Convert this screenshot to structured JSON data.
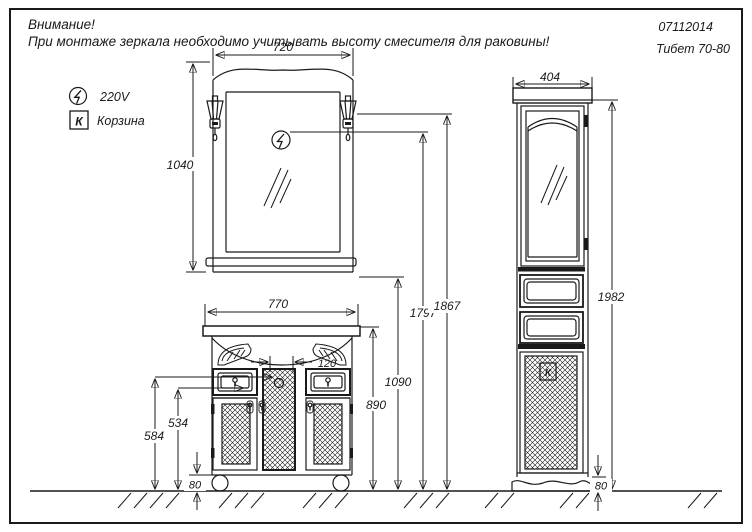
{
  "header": {
    "warning_title": "Внимание!",
    "warning_text": "При монтаже зеркала необходимо учитывать высоту смесителя для раковины!",
    "doc_number": "07112014",
    "model_name": "Тибет  70-80"
  },
  "legend": {
    "power_label": "220V",
    "basket_symbol": "К",
    "basket_label": "Корзина"
  },
  "mirror": {
    "width": "720",
    "height": "1040"
  },
  "vanity": {
    "width": "770",
    "recess_width": "120",
    "handle_height": "534",
    "drawer_top_height": "584",
    "leg_height": "80",
    "countertop_height": "890"
  },
  "heights": {
    "mirror_bottom": "1090",
    "socket": "1797",
    "lamp": "1867"
  },
  "cabinet": {
    "width": "404",
    "height": "1982",
    "plinth_height": "80",
    "basket_symbol": "К"
  },
  "colors": {
    "line": "#1a1a1a",
    "background": "#ffffff"
  }
}
